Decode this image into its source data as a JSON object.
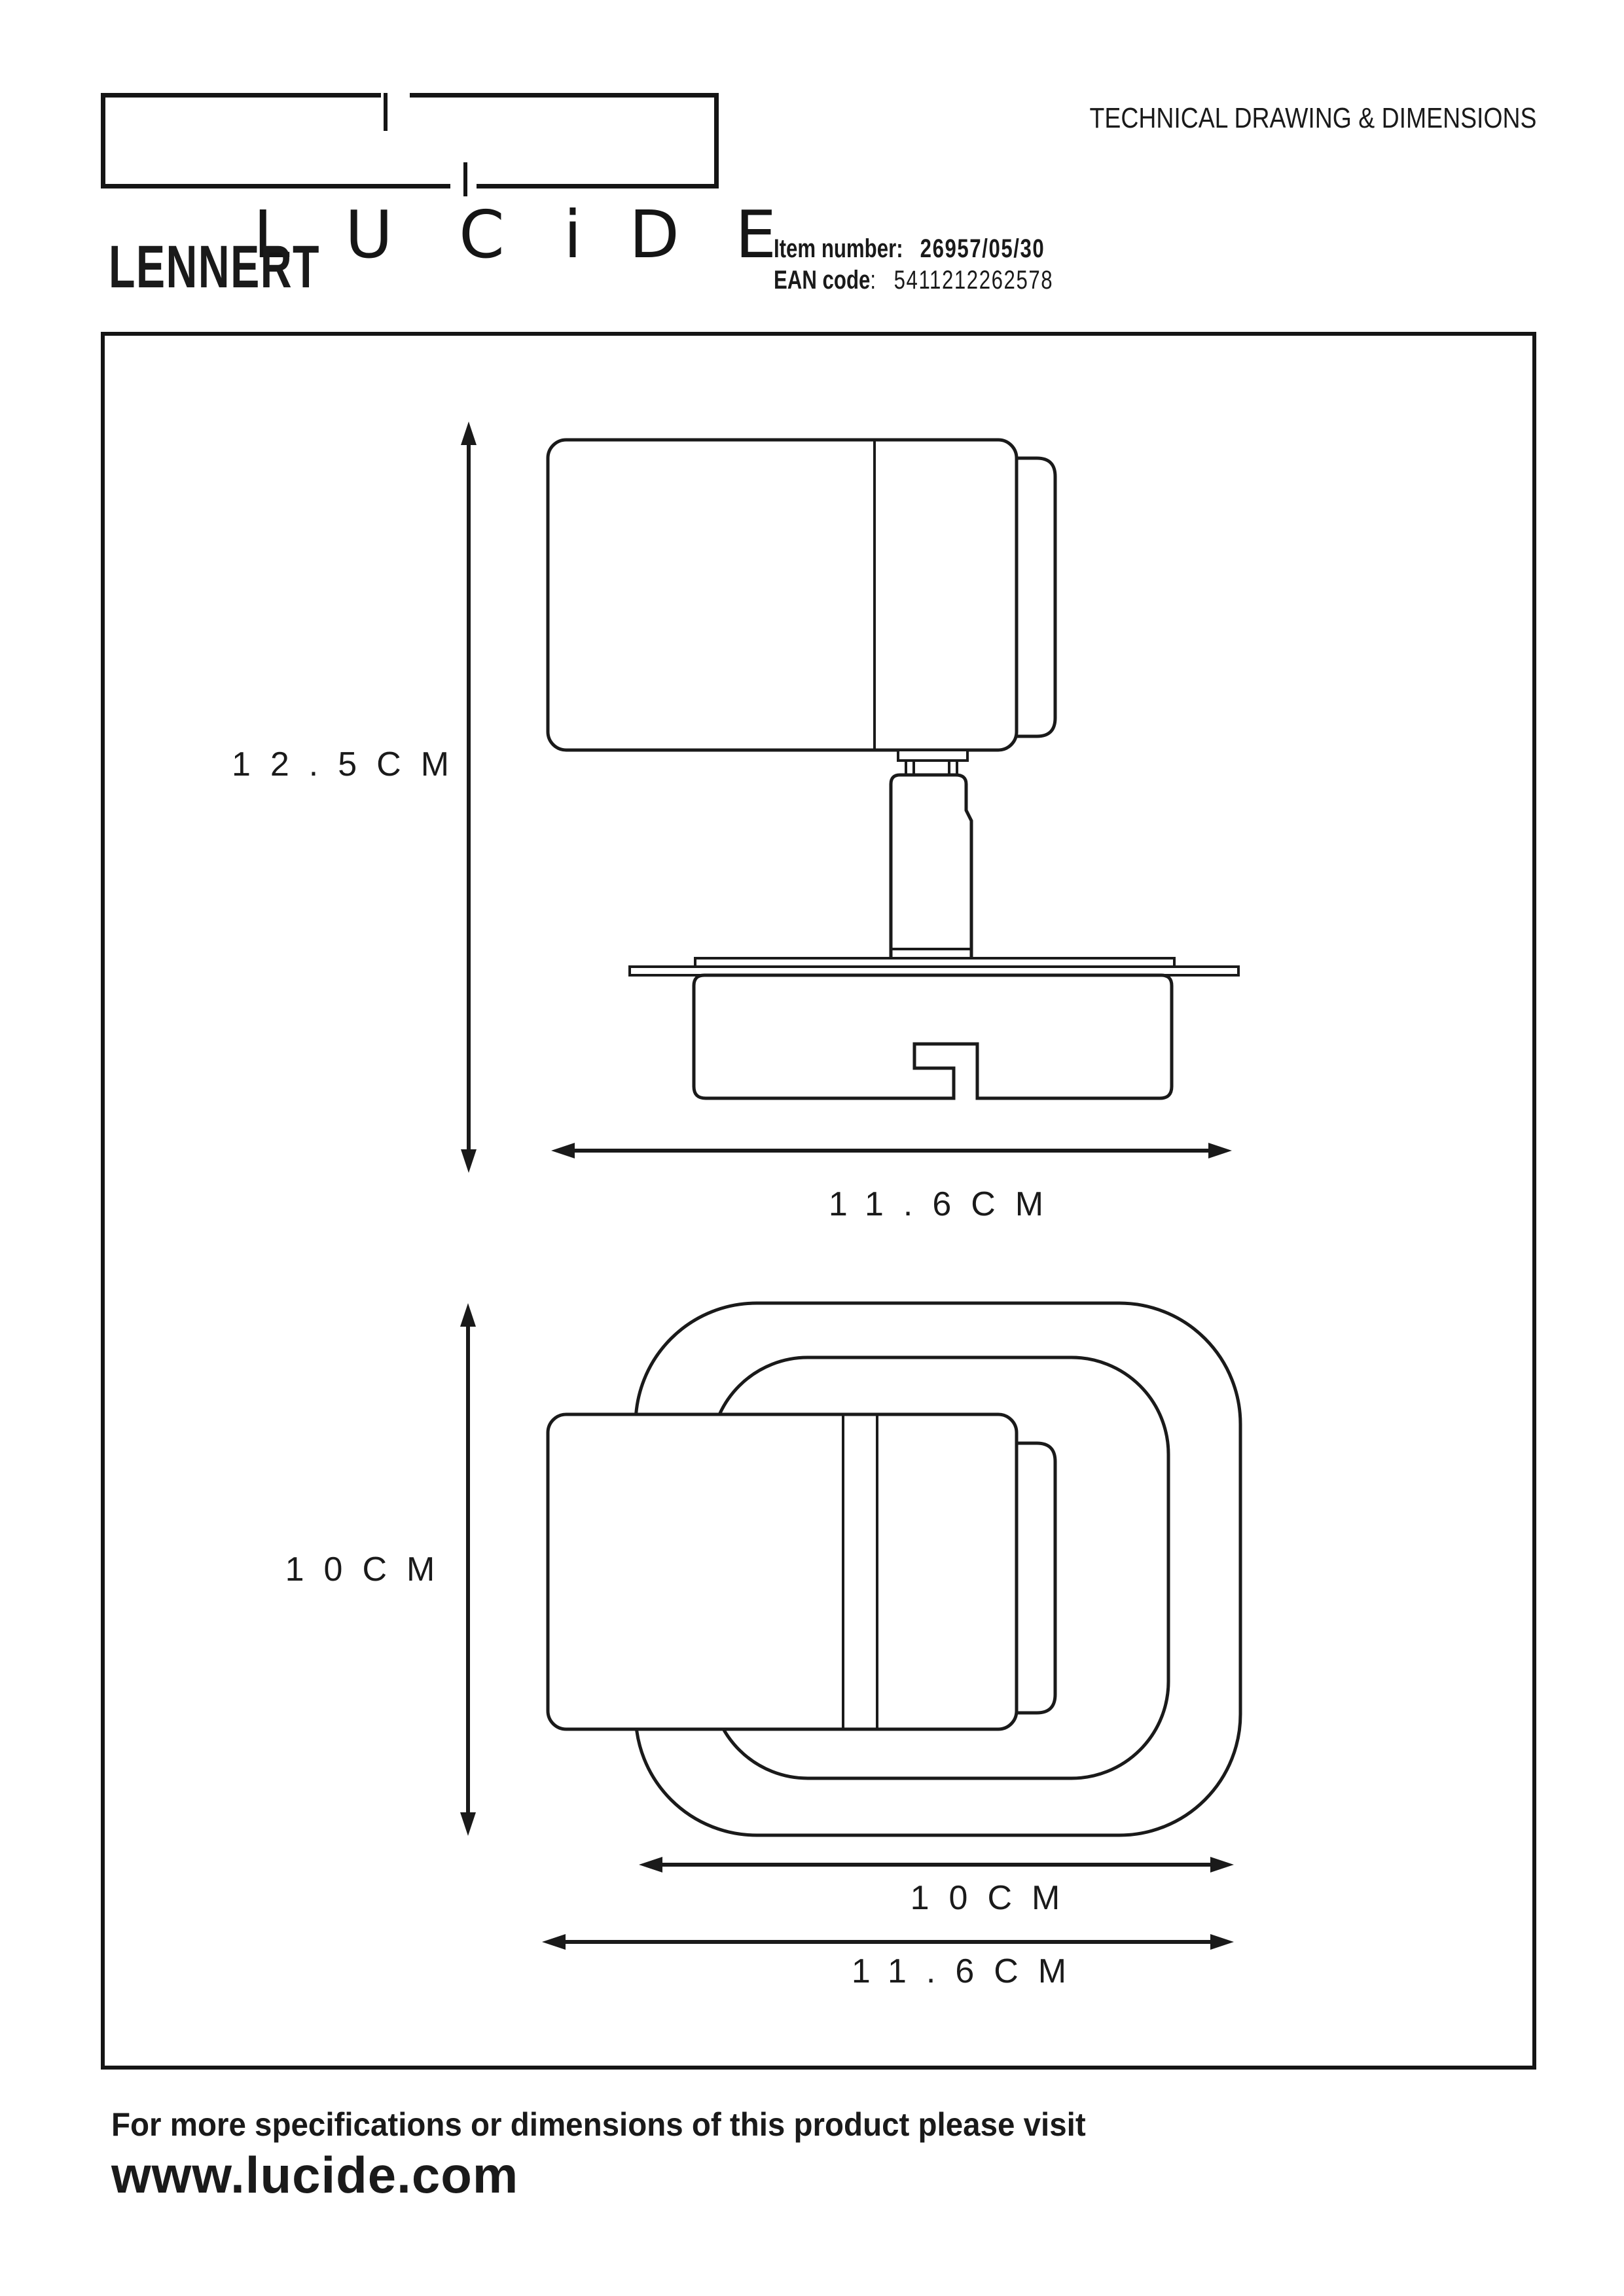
{
  "header": {
    "logo_letters": [
      "L",
      "U",
      "C",
      "i",
      "D",
      "E"
    ],
    "doc_title": "TECHNICAL DRAWING & DIMENSIONS",
    "product_name": "LENNERT",
    "item_number_label": "Item number:",
    "item_number_value": "26957/05/30",
    "ean_label": "EAN code",
    "ean_separator": ":",
    "ean_value": "5411212262578"
  },
  "drawing": {
    "side_view": {
      "height_label": "12.5CM",
      "width_label": "11.6CM"
    },
    "top_view": {
      "height_label": "10CM",
      "plate_width_label": "10CM",
      "overall_width_label": "11.6CM"
    }
  },
  "footer": {
    "note": "For more specifications or dimensions of this product please visit",
    "website": "www.lucide.com"
  },
  "colors": {
    "ink": "#1a1a1a",
    "background": "#ffffff"
  }
}
